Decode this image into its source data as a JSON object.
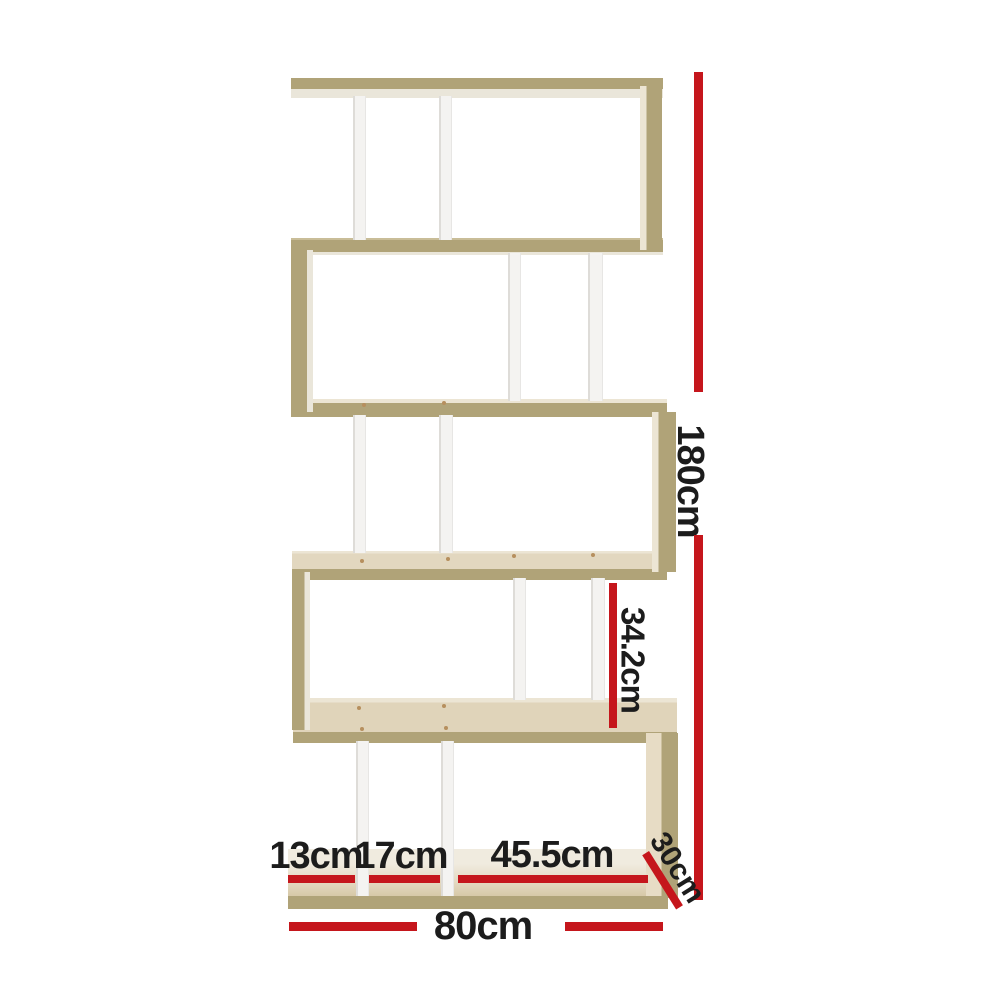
{
  "dimensions": {
    "total_height": "180cm",
    "shelf_section_height": "34.2cm",
    "left_section_width": "13cm",
    "middle_section_width": "17cm",
    "right_section_width": "45.5cm",
    "depth": "30cm",
    "total_width": "80cm"
  },
  "colors": {
    "annotation-red": "#c5161c",
    "label-text": "#1c1c1c",
    "wood-edge": "#b0a378",
    "wood-face-light": "#ece5d4",
    "wood-face-dark": "#d5c6a4",
    "wood-underside": "#eae6da",
    "divider-white": "#f4f3f1",
    "divider-shade": "#dedcd8",
    "screw": "#b68f5e",
    "background": "#ffffff"
  }
}
